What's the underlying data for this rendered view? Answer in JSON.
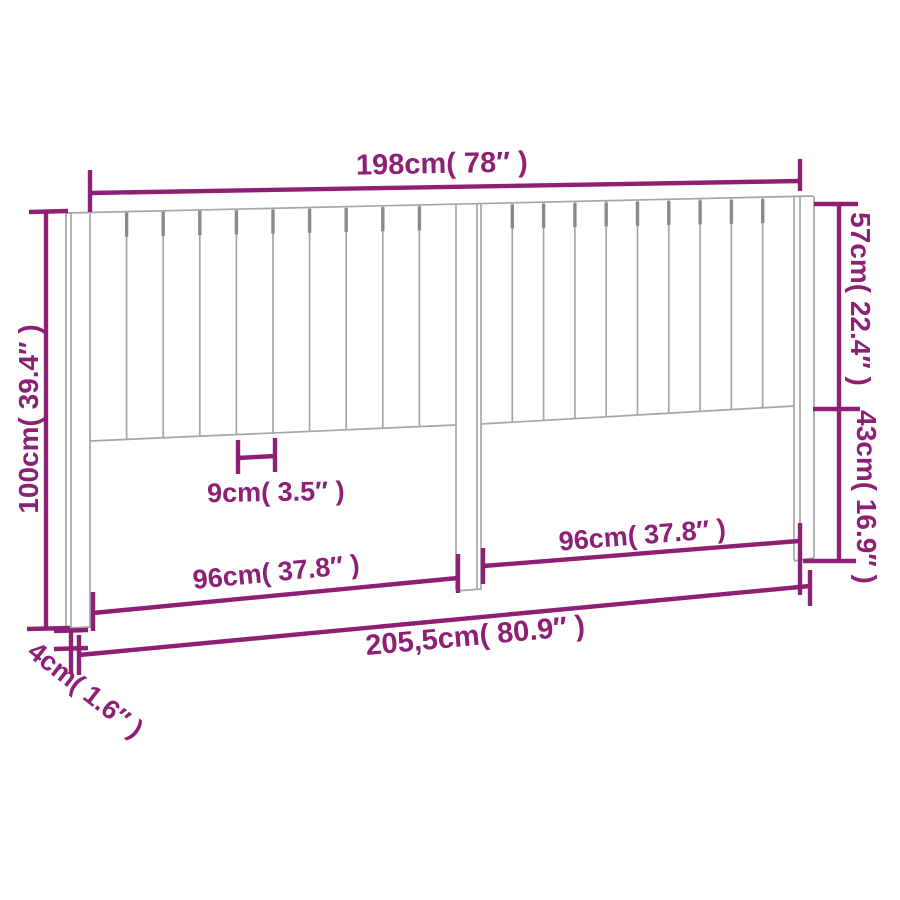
{
  "drawing": {
    "type": "product-dimension-diagram",
    "subject": "headboard-with-vertical-slats",
    "labels": {
      "top_width": "198cm( 78″ )",
      "right_upper_height": "57cm( 22.4″ )",
      "right_lower_height": "43cm( 16.9″ )",
      "left_height": "100cm( 39.4″ )",
      "slat_width": "9cm( 3.5″ )",
      "left_panel_width": "96cm( 37.8″ )",
      "right_panel_width": "96cm( 37.8″ )",
      "total_width": "205,5cm( 80.9″ )",
      "leg_depth": "4cm( 1.6″ )"
    },
    "dimensions": [
      {
        "name": "top_width",
        "cm": 198,
        "inches": 78
      },
      {
        "name": "right_upper_height",
        "cm": 57,
        "inches": 22.4
      },
      {
        "name": "right_lower_height",
        "cm": 43,
        "inches": 16.9
      },
      {
        "name": "left_height",
        "cm": 100,
        "inches": 39.4
      },
      {
        "name": "slat_width",
        "cm": 9,
        "inches": 3.5
      },
      {
        "name": "left_panel_width",
        "cm": 96,
        "inches": 37.8
      },
      {
        "name": "right_panel_width",
        "cm": 96,
        "inches": 37.8
      },
      {
        "name": "total_width",
        "cm": 205.5,
        "inches": 80.9
      },
      {
        "name": "leg_depth",
        "cm": 4,
        "inches": 1.6
      }
    ],
    "colors": {
      "dimension_accent": "#8d1f75",
      "outline": "#a6a6a6",
      "outline_dark": "#8a8a8a",
      "background": "#ffffff"
    }
  }
}
